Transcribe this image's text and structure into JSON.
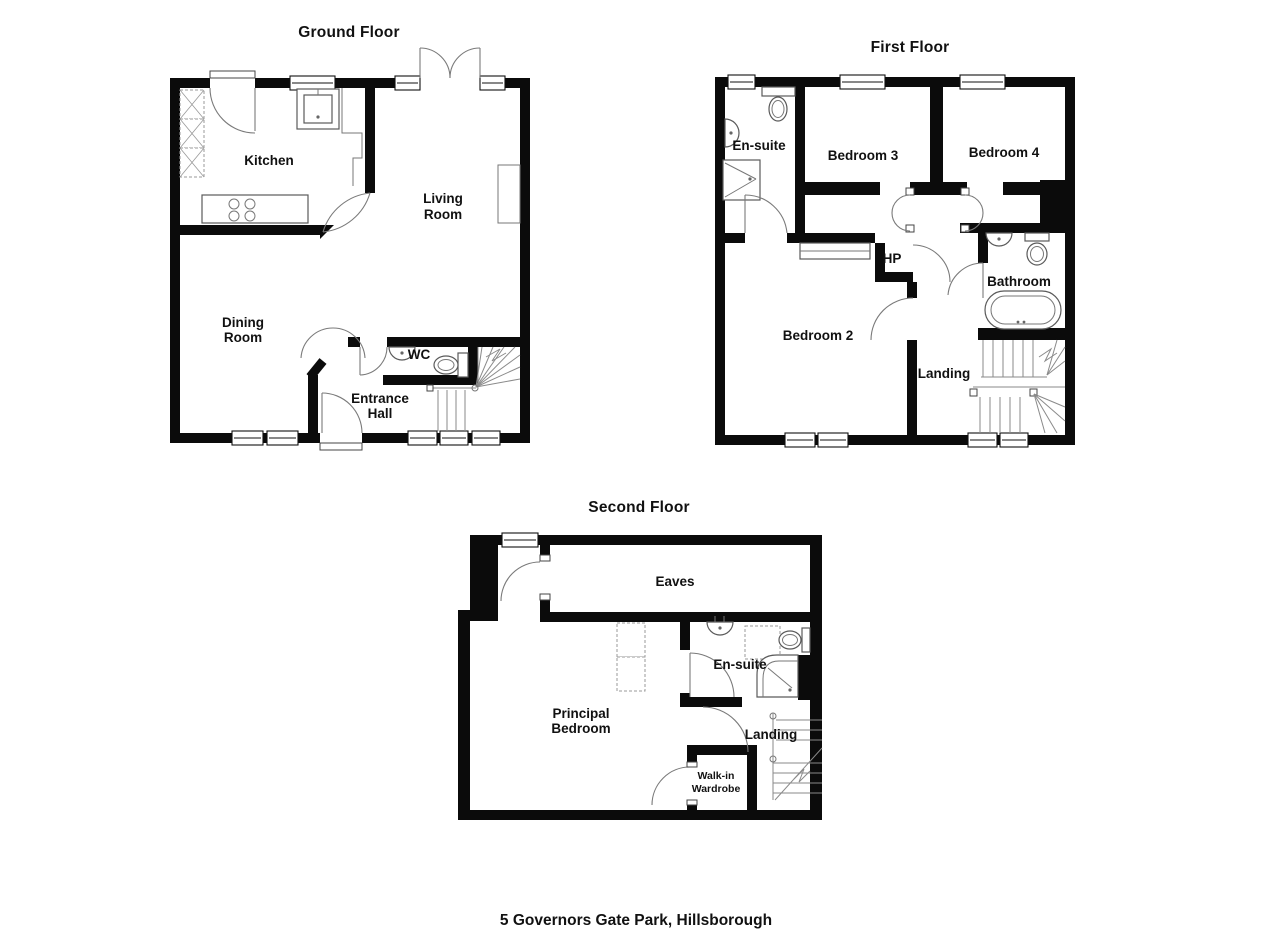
{
  "colors": {
    "wall": "#0b0b0b",
    "line": "#7a7a7a",
    "background": "#ffffff"
  },
  "caption": "5 Governors Gate Park, Hillsborough",
  "floors": {
    "ground": {
      "title": "Ground Floor",
      "rooms": {
        "kitchen": "Kitchen",
        "living_room": [
          "Living",
          "Room"
        ],
        "dining_room": [
          "Dining",
          "Room"
        ],
        "wc": "WC",
        "entrance_hall": [
          "Entrance",
          "Hall"
        ]
      }
    },
    "first": {
      "title": "First Floor",
      "rooms": {
        "ensuite": "En-suite",
        "bedroom3": "Bedroom 3",
        "bedroom4": "Bedroom 4",
        "hp": "HP",
        "bathroom": "Bathroom",
        "bedroom2": "Bedroom 2",
        "landing": "Landing"
      }
    },
    "second": {
      "title": "Second Floor",
      "rooms": {
        "eaves": "Eaves",
        "ensuite": "En-suite",
        "principal_bedroom": [
          "Principal",
          "Bedroom"
        ],
        "landing": "Landing",
        "walkin_wardrobe": [
          "Walk-in",
          "Wardrobe"
        ]
      }
    }
  }
}
